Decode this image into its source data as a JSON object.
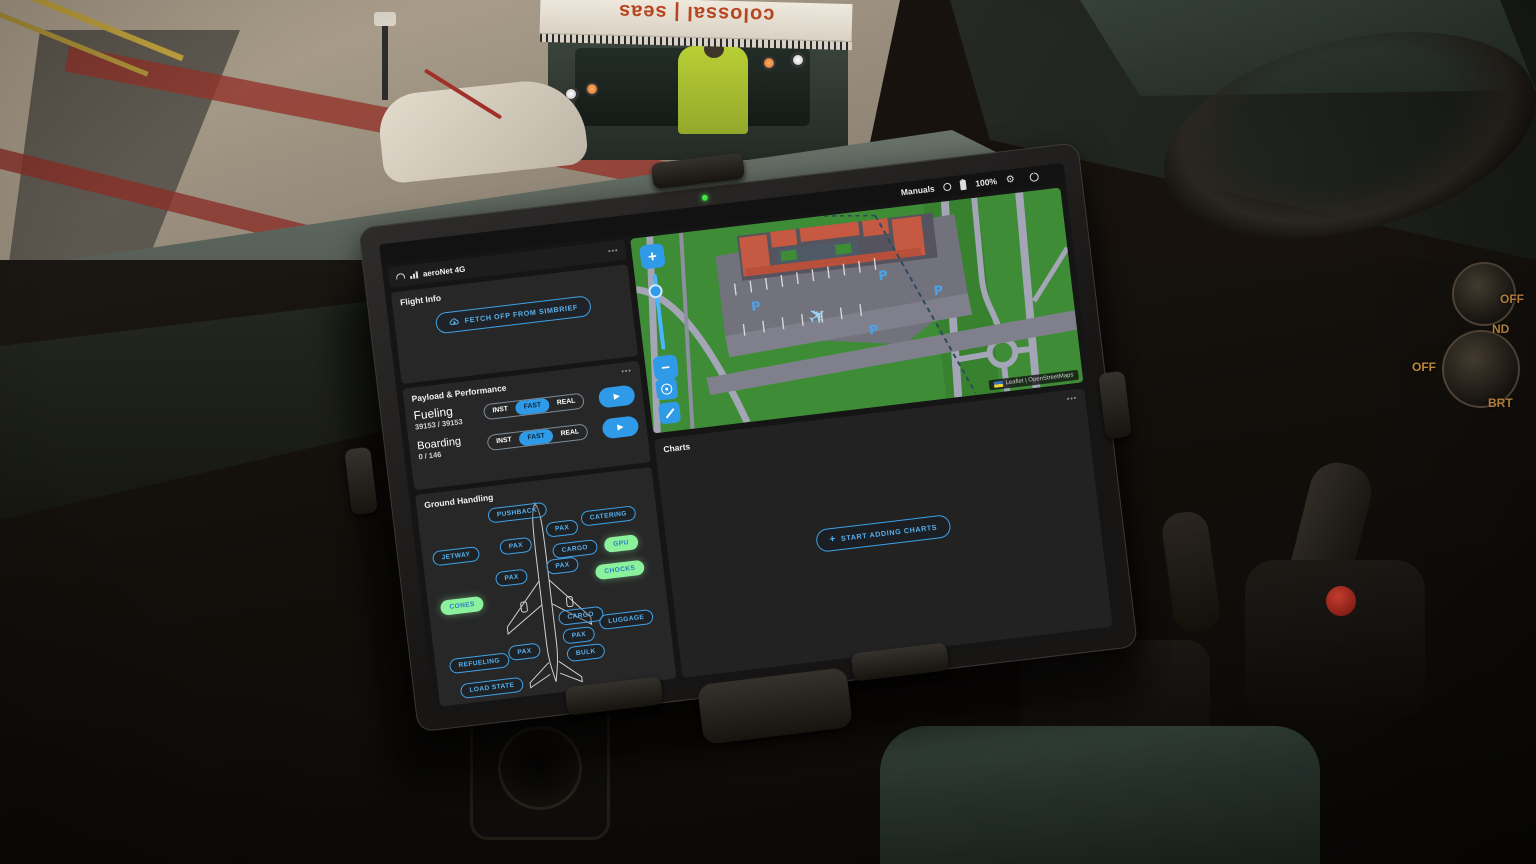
{
  "scene": {
    "tug_sign": "colossal | seas",
    "knob_labels": [
      "OFF",
      "ND",
      "OFF",
      "BRT"
    ]
  },
  "icons": {
    "menu": "•••",
    "gear": "⚙",
    "play": "▶",
    "plus": "+",
    "plane": "✈"
  },
  "tablet": {
    "status_bar": {
      "manuals": "Manuals",
      "battery": "100%"
    },
    "network": {
      "label": "aeroNet 4G"
    },
    "flight_info": {
      "title": "Flight Info",
      "fetch_button": "FETCH OFP FROM SIMBRIEF"
    },
    "payload": {
      "title": "Payload & Performance",
      "fueling": {
        "label": "Fueling",
        "value": "39153 / 39153",
        "modes": [
          "INST",
          "FAST",
          "REAL"
        ],
        "active": "FAST"
      },
      "boarding": {
        "label": "Boarding",
        "value": "0 / 146",
        "modes": [
          "INST",
          "FAST",
          "REAL"
        ],
        "active": "FAST"
      }
    },
    "ground_handling": {
      "title": "Ground Handling",
      "buttons": [
        {
          "label": "PUSHBACK",
          "state": "off"
        },
        {
          "label": "JETWAY",
          "state": "off"
        },
        {
          "label": "PAX",
          "state": "off"
        },
        {
          "label": "PAX",
          "state": "off"
        },
        {
          "label": "CARGO",
          "state": "off"
        },
        {
          "label": "CATERING",
          "state": "off"
        },
        {
          "label": "GPU",
          "state": "on"
        },
        {
          "label": "PAX",
          "state": "off"
        },
        {
          "label": "PAX",
          "state": "off"
        },
        {
          "label": "CHOCKS",
          "state": "on"
        },
        {
          "label": "CONES",
          "state": "on"
        },
        {
          "label": "CARGO",
          "state": "off"
        },
        {
          "label": "LUGGAGE",
          "state": "off"
        },
        {
          "label": "PAX",
          "state": "off"
        },
        {
          "label": "BULK",
          "state": "off"
        },
        {
          "label": "PAX",
          "state": "off"
        },
        {
          "label": "REFUELING",
          "state": "off"
        },
        {
          "label": "LOAD STATE",
          "state": "off"
        }
      ]
    },
    "map": {
      "zoom_in": "+",
      "zoom_out": "−",
      "parking_label": "P",
      "attribution": "Leaflet | OpenStreetMaps"
    },
    "charts": {
      "title": "Charts",
      "add_button": "START ADDING CHARTS"
    }
  },
  "colors": {
    "accent": "#3FA2E8",
    "active_green": "#8BF19C",
    "map_green": "#3E8C36"
  }
}
